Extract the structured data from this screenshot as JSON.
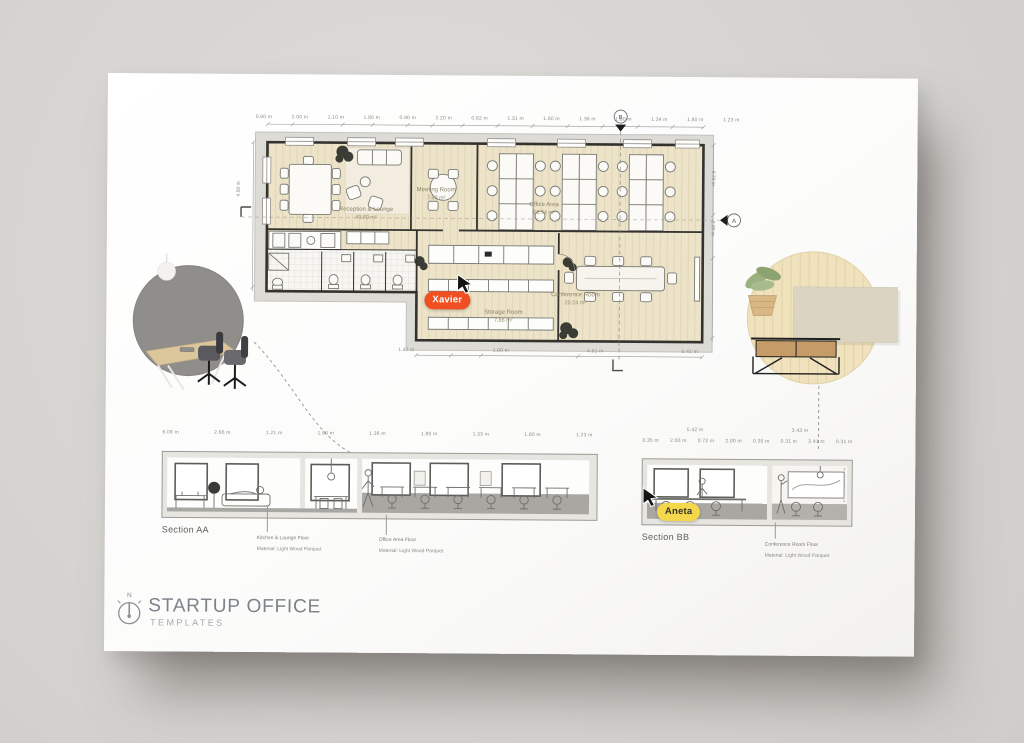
{
  "poster": {
    "title": "STARTUP OFFICE",
    "subtitle": "TEMPLATES",
    "north_indicator": "N"
  },
  "cursors": {
    "xavier": {
      "name": "Xavier",
      "color": "#F04F21"
    },
    "aneta": {
      "name": "Aneta",
      "color": "#F5D74B"
    }
  },
  "floor_plan": {
    "rooms": {
      "reception": {
        "name": "Reception & Lounge",
        "area": "49.80 m²"
      },
      "meeting": {
        "name": "Meeting Room",
        "area": "7.80 m²"
      },
      "office": {
        "name": "Office Area",
        "area": "66.74 m²"
      },
      "storage": {
        "name": "Storage Room",
        "area": "7.86 m²"
      },
      "conference": {
        "name": "Conference Room",
        "area": "20.24 m²"
      }
    },
    "section_markers": {
      "top": "B",
      "right": "A"
    },
    "dims_top": [
      "0.60 m",
      "2.00 m",
      "1.10 m",
      "1.80 m",
      "0.90 m",
      "2.20 m",
      "0.62 m",
      "1.31 m",
      "1.80 m",
      "1.36 m",
      "1.80 m",
      "1.34 m",
      "1.80 m",
      "1.23 m"
    ],
    "dims_bottom": [
      "1.47 m",
      "1.00 m",
      "4.51 m",
      "5.41 m"
    ],
    "dim_left": "4.50 m",
    "dims_right": [
      "0.70 m",
      "2.00 m"
    ]
  },
  "section_aa": {
    "label": "Section AA",
    "dims": [
      "6.08 m",
      "2.66 m",
      "1.21 m",
      "1.80 m",
      "1.36 m",
      "1.80 m",
      "1.33 m",
      "1.80 m",
      "1.23 m"
    ],
    "annotations": [
      {
        "title": "Kitchen & Lounge Floor",
        "material": "Material: Light Wood Parquet"
      },
      {
        "title": "Office Area Floor",
        "material": "Material: Light Wood Parquet"
      }
    ]
  },
  "section_bb": {
    "label": "Section BB",
    "dims_overall": [
      "5.42 m",
      "3.43 m"
    ],
    "dims_detail": [
      "0.35 m",
      "2.00 m",
      "0.72 m",
      "2.00 m",
      "0.35 m",
      "0.31 m",
      "2.41 m",
      "0.31 m"
    ],
    "annotations": [
      {
        "title": "Conference Room Floor",
        "material": "Material: Light Wood Parquet"
      }
    ]
  }
}
